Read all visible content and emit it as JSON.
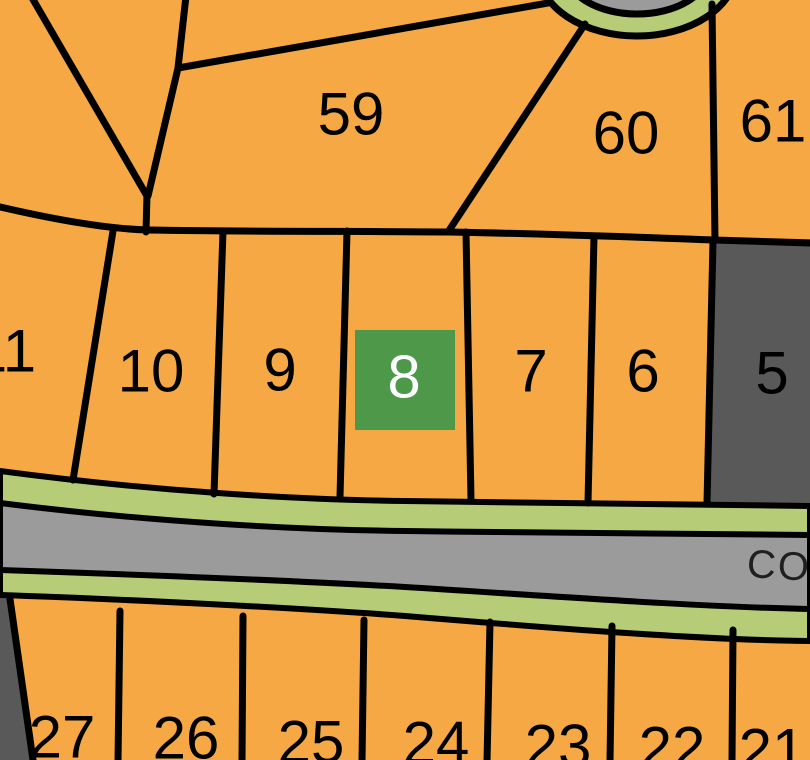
{
  "map": {
    "type": "subdivision-plat-map",
    "road": {
      "name_visible": "CO"
    },
    "selection": {
      "lot": "8",
      "marker_color": "#4D9949",
      "text_color": "#FFFFFF"
    },
    "labels": {
      "lot59": "59",
      "lot60": "60",
      "lot61": "61",
      "lot11": "11",
      "lot10": "10",
      "lot9": "9",
      "lot8": "8",
      "lot7": "7",
      "lot6": "6",
      "lot5": "5",
      "lot27": "27",
      "lot26": "26",
      "lot25": "25",
      "lot24": "24",
      "lot23": "23",
      "lot22": "22",
      "lot21": "21"
    },
    "colors": {
      "parcel_orange": "#F5A844",
      "boundary_black": "#000000",
      "road_gray": "#9B9B9B",
      "verge_green": "#B6CC76",
      "unavailable_gray": "#59595A",
      "selected_green": "#4D9949",
      "number_black": "#000000"
    }
  }
}
